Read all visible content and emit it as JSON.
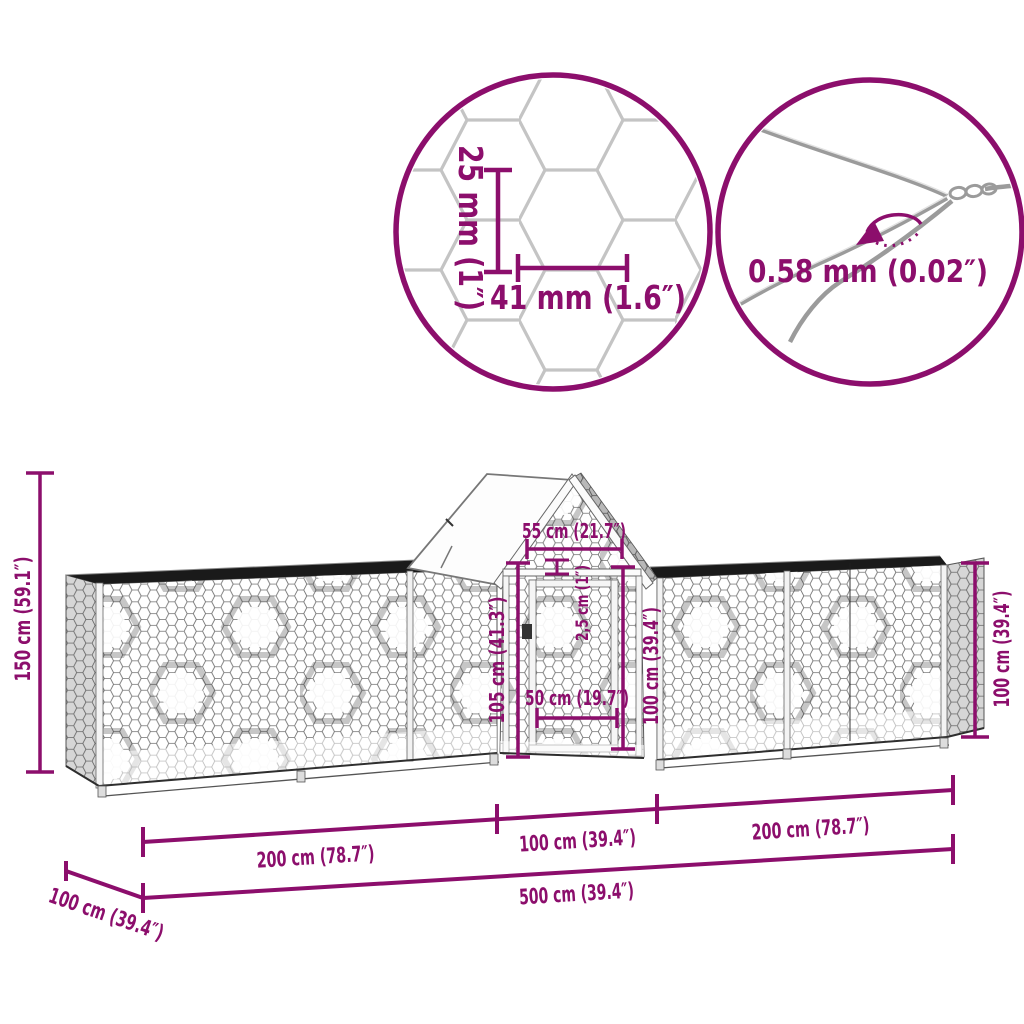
{
  "figure": {
    "type": "product dimension diagram",
    "subject": "chicken coop with mesh runs"
  },
  "colors": {
    "dimension_accent": "#8C0E6C",
    "mesh_light": "#c6c6c6",
    "mesh_dark": "#707070",
    "frame_dark": "#1a1a1a",
    "wire_gray": "#9b9b9b"
  },
  "callouts": {
    "mesh": {
      "height": "25 mm (1″)",
      "width": "41 mm (1.6″)"
    },
    "wire": {
      "thickness": "0.58 mm (0.02″)"
    }
  },
  "dimensions": {
    "overall_height": "150 cm (59.1″)",
    "run_height_right": "100 cm (39.4″)",
    "coop_top_width": "55 cm (21.7″)",
    "frame_profile": "2,5 cm (1″)",
    "coop_front_height": "105 cm (41.3″)",
    "door_height": "100 cm (39.4″)",
    "door_width": "50 cm (19.7″)",
    "left_run_length": "200 cm (78.7″)",
    "coop_section_length": "100 cm (39.4″)",
    "right_run_length": "200 cm (78.7″)",
    "total_length": "500 cm (39.4″)",
    "depth": "100 cm (39.4″)"
  }
}
